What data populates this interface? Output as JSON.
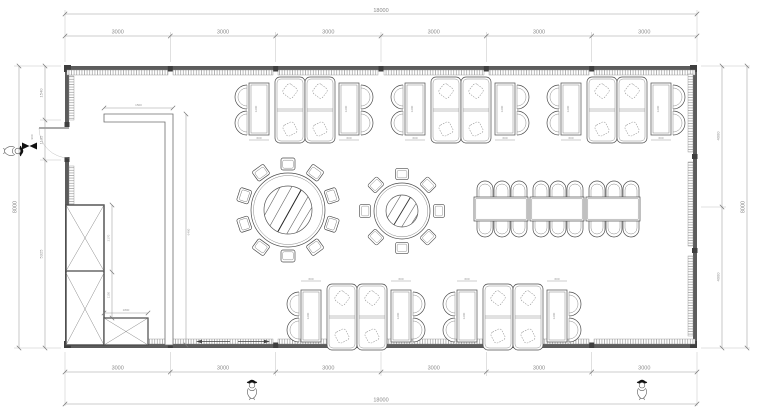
{
  "meta": {
    "drawing_type": "restaurant dining hall furniture floor plan"
  },
  "dims": {
    "top": {
      "overall": "18000",
      "segments": [
        "3000",
        "3000",
        "3000",
        "3000",
        "3000",
        "3000"
      ]
    },
    "bottom": {
      "overall": "18000",
      "segments": [
        "3000",
        "3000",
        "3000",
        "3000",
        "3000",
        "3000"
      ]
    },
    "left": {
      "overall": "8000",
      "top": "1540",
      "door": "1135",
      "bottom": "5325",
      "door_leaf": "900"
    },
    "right": {
      "overall": "8000",
      "upper": "4000",
      "lower": "4000"
    },
    "partition": {
      "length": "1500",
      "depth": "6460"
    },
    "cabinet": {
      "upper": "2170",
      "lower": "1150",
      "bench": "1800"
    },
    "table": {
      "width": "600",
      "length": "1200"
    }
  },
  "furniture": {
    "booth_sofa_units": 10,
    "rect_tables_with_two_chairs": 10,
    "round_table_large_seats": 10,
    "round_table_small_seats": 8,
    "banquet_tables": 3,
    "banquet_chairs": 18,
    "tall_cabinet_sections": 2,
    "low_cabinet_sections": 1,
    "person_figures": 3
  }
}
